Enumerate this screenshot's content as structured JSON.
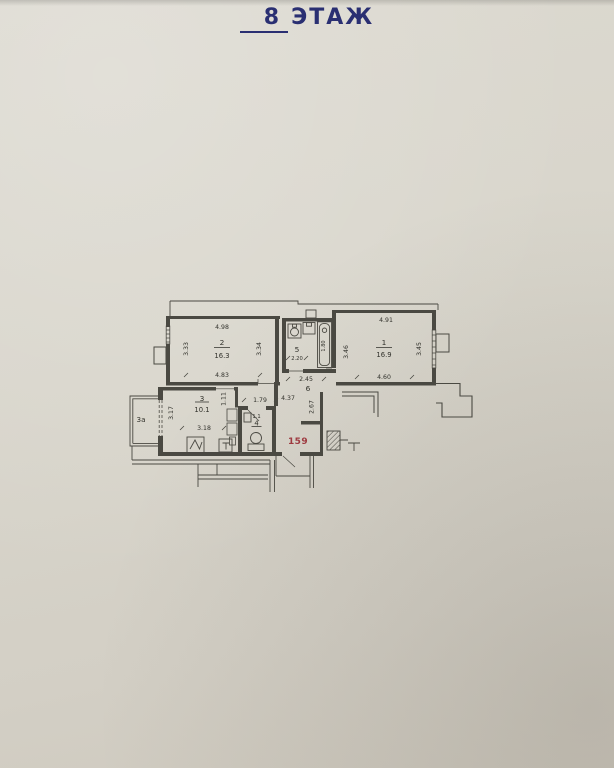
{
  "title": {
    "floor": "8",
    "word": "ЭТАЖ"
  },
  "plan": {
    "apartment_number": "159",
    "room1": {
      "number": "1",
      "area": "16.9",
      "dim_top": "4.91",
      "dim_left": "3.46",
      "dim_right": "3.45",
      "dim_bottom": "4.60"
    },
    "room2": {
      "number": "2",
      "area": "16.3",
      "dim_top": "4.98",
      "dim_left": "3.33",
      "dim_right": "3.34",
      "dim_bottom": "4.83"
    },
    "room3": {
      "number": "3",
      "area": "10.1",
      "dim_left": "3.17",
      "dim_bottom": "3.18"
    },
    "room3a": {
      "number": "3а"
    },
    "room4": {
      "number": "4",
      "dim_above": "1.1"
    },
    "room5": {
      "number": "5",
      "dim_bottom": "2.20",
      "bath_length": "1.80"
    },
    "room6": {
      "number": "6",
      "dim_top": "2.45",
      "dim_length": "4.37",
      "dim_left": "1.79",
      "dim_right": "2.67",
      "dim_closet": "1.11"
    },
    "colors": {
      "ink": "#4a4942",
      "text": "#32322c",
      "red": "#9e3a40",
      "blue": "#2a2f72",
      "paper": "#d8d4ca"
    }
  }
}
